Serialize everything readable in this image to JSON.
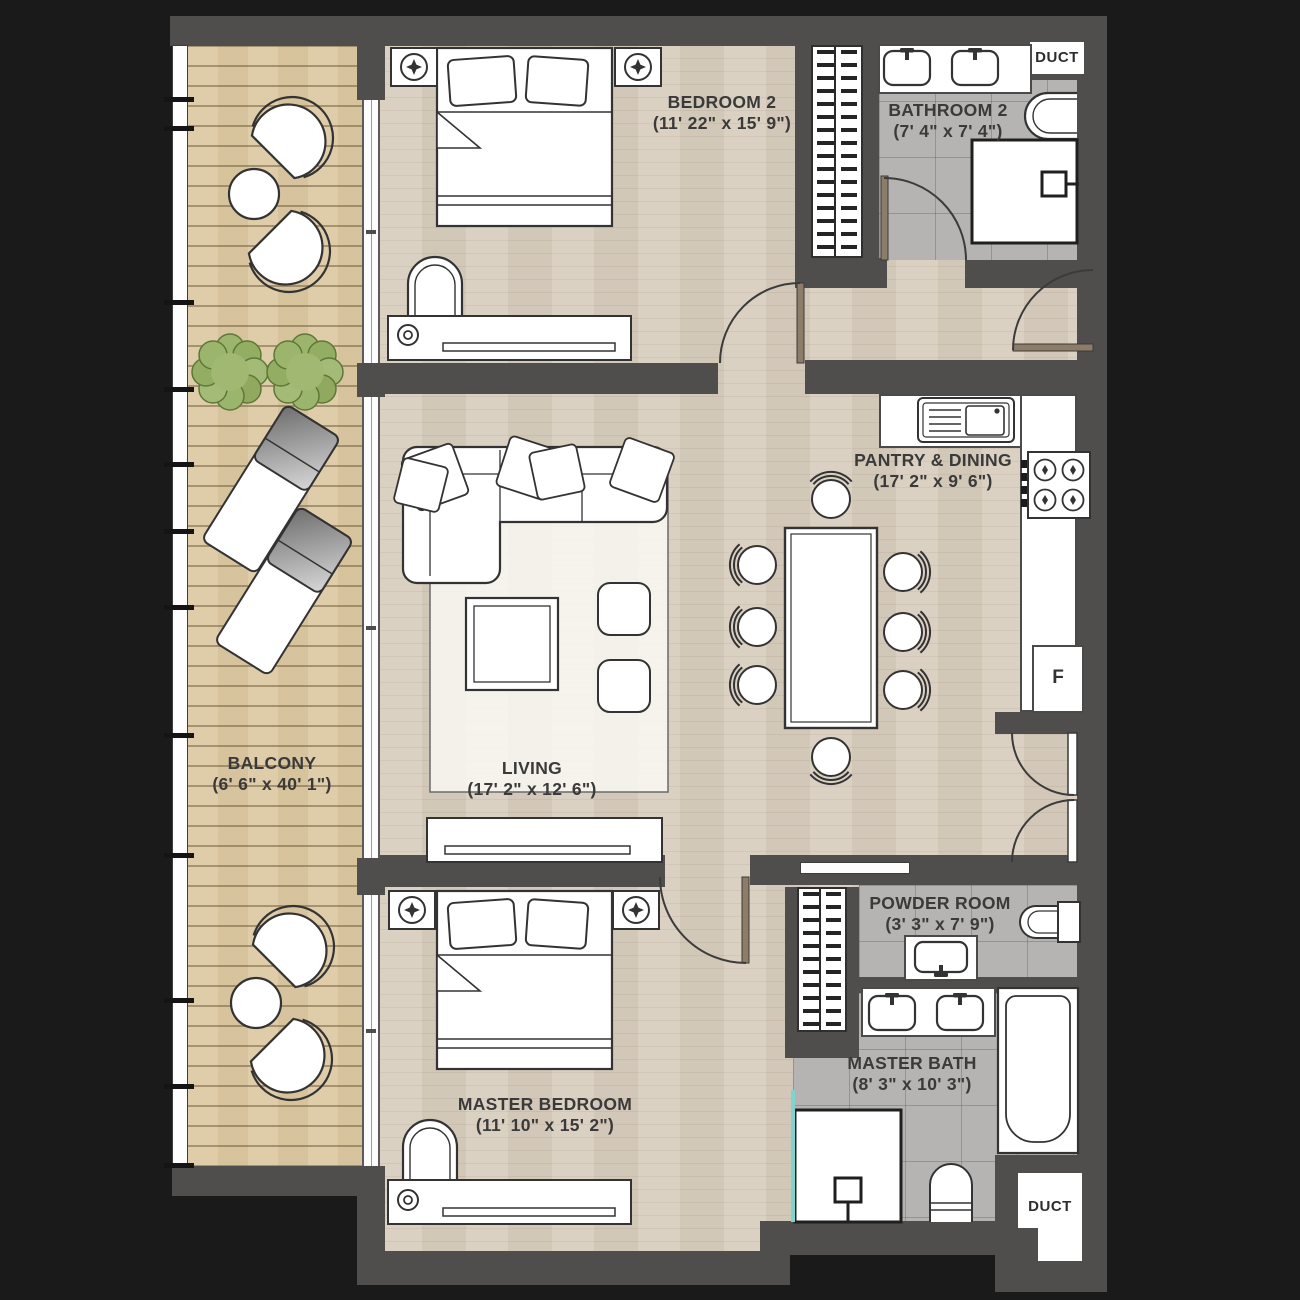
{
  "plan": {
    "rooms": [
      {
        "name": "BEDROOM 2",
        "dims": "(11' 22\" x 15' 9\")"
      },
      {
        "name": "BATHROOM 2",
        "dims": "(7' 4\" x 7' 4\")"
      },
      {
        "name": "PANTRY & DINING",
        "dims": "(17' 2\" x 9' 6\")"
      },
      {
        "name": "LIVING",
        "dims": "(17' 2\" x 12' 6\")"
      },
      {
        "name": "BALCONY",
        "dims": "(6' 6\" x 40' 1\")"
      },
      {
        "name": "MASTER BEDROOM",
        "dims": "(11' 10\" x 15' 2\")"
      },
      {
        "name": "POWDER ROOM",
        "dims": "(3' 3\" x 7' 9\")"
      },
      {
        "name": "MASTER BATH",
        "dims": "(8' 3\" x 10' 3\")"
      }
    ],
    "fixtures": {
      "duct_top": "DUCT",
      "duct_bottom": "DUCT",
      "fridge": "F"
    },
    "colors": {
      "background": "#1a1a1a",
      "wall": "#4f4e4d",
      "wood_floor": "#d9cfc0",
      "deck_floor": "#ddcaa4",
      "tile_floor": "#b5b4b2",
      "plant_green": "#9cb56d",
      "glass_teal": "#7fd4cf",
      "door_leaf": "#8d7c68"
    }
  }
}
